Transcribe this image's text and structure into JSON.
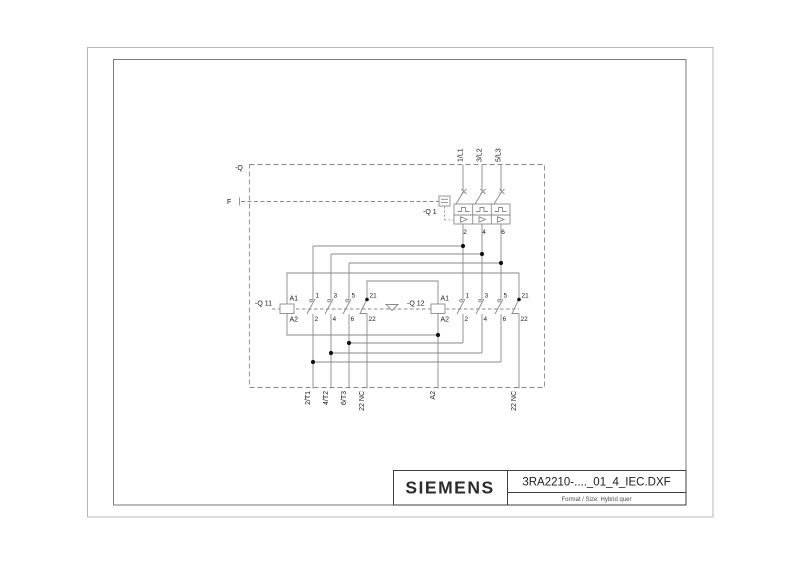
{
  "title_block": {
    "brand": "SIEMENS",
    "drawing_name": "3RA2210-...._01_4_IEC.DXF",
    "format_info": "Format / Size: Hybrid quer"
  },
  "schematic": {
    "feeder_label": "-Q",
    "trip_line_label": "F",
    "incoming_lines": [
      "1/L1",
      "3/L2",
      "5/L3"
    ],
    "breaker": {
      "label": "-Q 1",
      "outlet_terminals": [
        "2",
        "4",
        "6"
      ]
    },
    "contactor_left": {
      "label": "-Q 11",
      "coil": {
        "top": "A1",
        "bottom": "A2"
      },
      "poles": [
        {
          "t": "1",
          "b": "2"
        },
        {
          "t": "3",
          "b": "4"
        },
        {
          "t": "5",
          "b": "6"
        }
      ],
      "aux": {
        "t": "21",
        "b": "22"
      }
    },
    "contactor_right": {
      "label": "-Q 12",
      "coil": {
        "top": "A1",
        "bottom": "A2"
      },
      "poles": [
        {
          "t": "1",
          "b": "2"
        },
        {
          "t": "3",
          "b": "4"
        },
        {
          "t": "5",
          "b": "6"
        }
      ],
      "aux": {
        "t": "21",
        "b": "22"
      }
    },
    "outgoing_terminals": [
      "2/T1",
      "4/T2",
      "6/T3",
      "22 NC",
      "A2",
      "22 NC"
    ]
  },
  "colors": {
    "line": "#8a8a8a",
    "text": "#1a1a1a",
    "frame_outer": "#b7b7b7",
    "frame_inner": "#7a7a7a",
    "junction_dot": "#111111",
    "background": "#ffffff"
  }
}
